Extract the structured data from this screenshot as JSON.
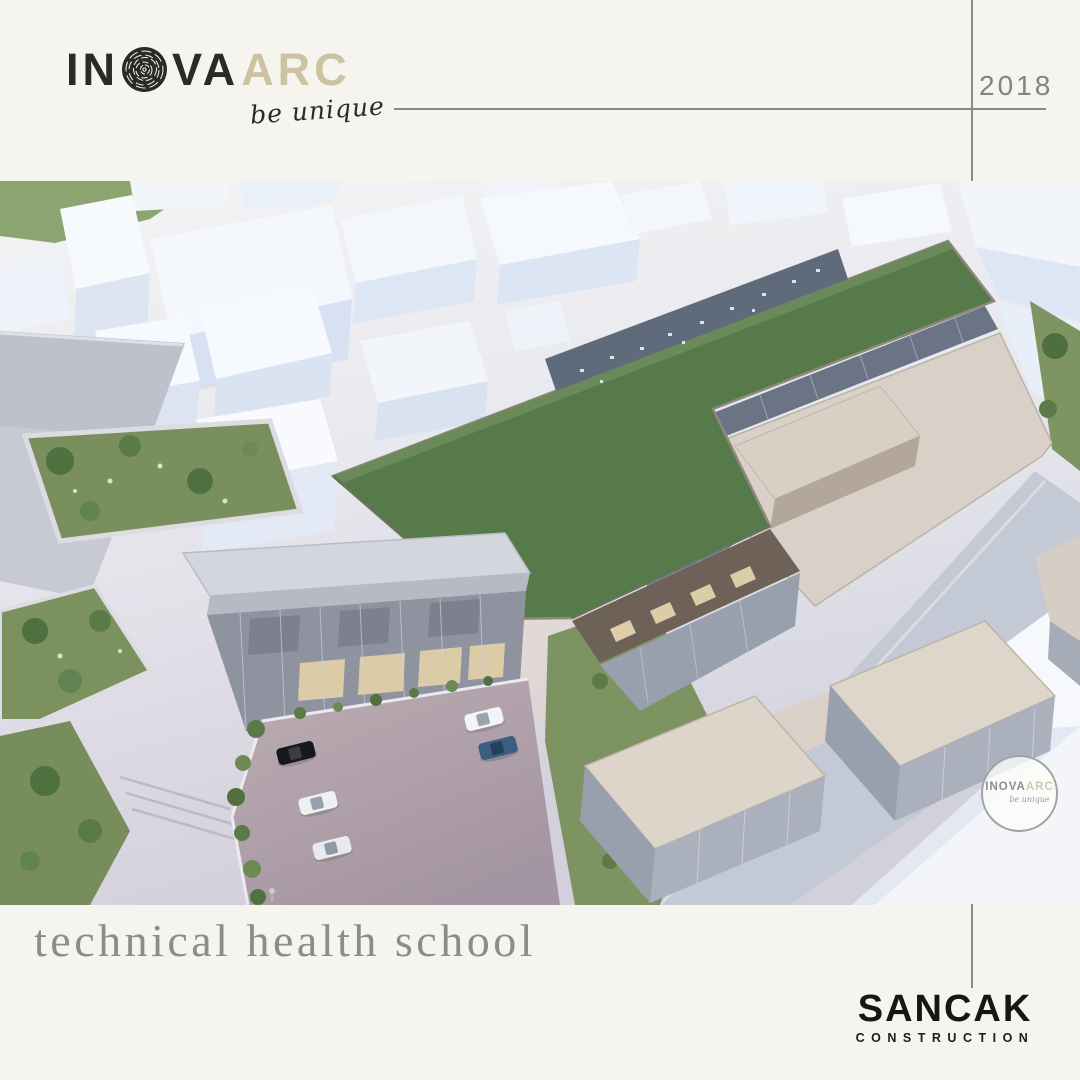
{
  "header": {
    "logo": {
      "in": "IN",
      "va": "VA",
      "arc": "ARC",
      "tagline": "be unique"
    },
    "year": "2018"
  },
  "watermark": {
    "inova": "INOVA",
    "arc": "ARC",
    "tagline": "be unique"
  },
  "footer": {
    "project_title": "technical health school",
    "brand": {
      "name": "SANCAK",
      "subtitle": "CONSTRUCTION"
    }
  },
  "render": {
    "description": "aerial 3d rendering of a technical health school: L-shaped building with green flat roof, glass curtain walls, beige courtyard roofs, white context massing buildings, gardens, plaza and parking lot with five cars",
    "colors": {
      "page_background": "#f5f4ef",
      "logo_dark": "#2b2a26",
      "logo_beige": "#cdc3a2",
      "rule_gray": "#8b8b85",
      "year_gray": "#84847e",
      "title_gray": "#8c8c8c",
      "brand_black": "#161616",
      "roof_green": "#567a49",
      "lawn_green": "#7d9362",
      "roof_tan": "#d9d0c7",
      "glass_blue": "#6b7484",
      "road_gray": "#b8bbc5",
      "parking_mauve": "#ab9da6",
      "city_white": "#f4f8fc",
      "city_face_blue": "#dbe5f3"
    }
  }
}
